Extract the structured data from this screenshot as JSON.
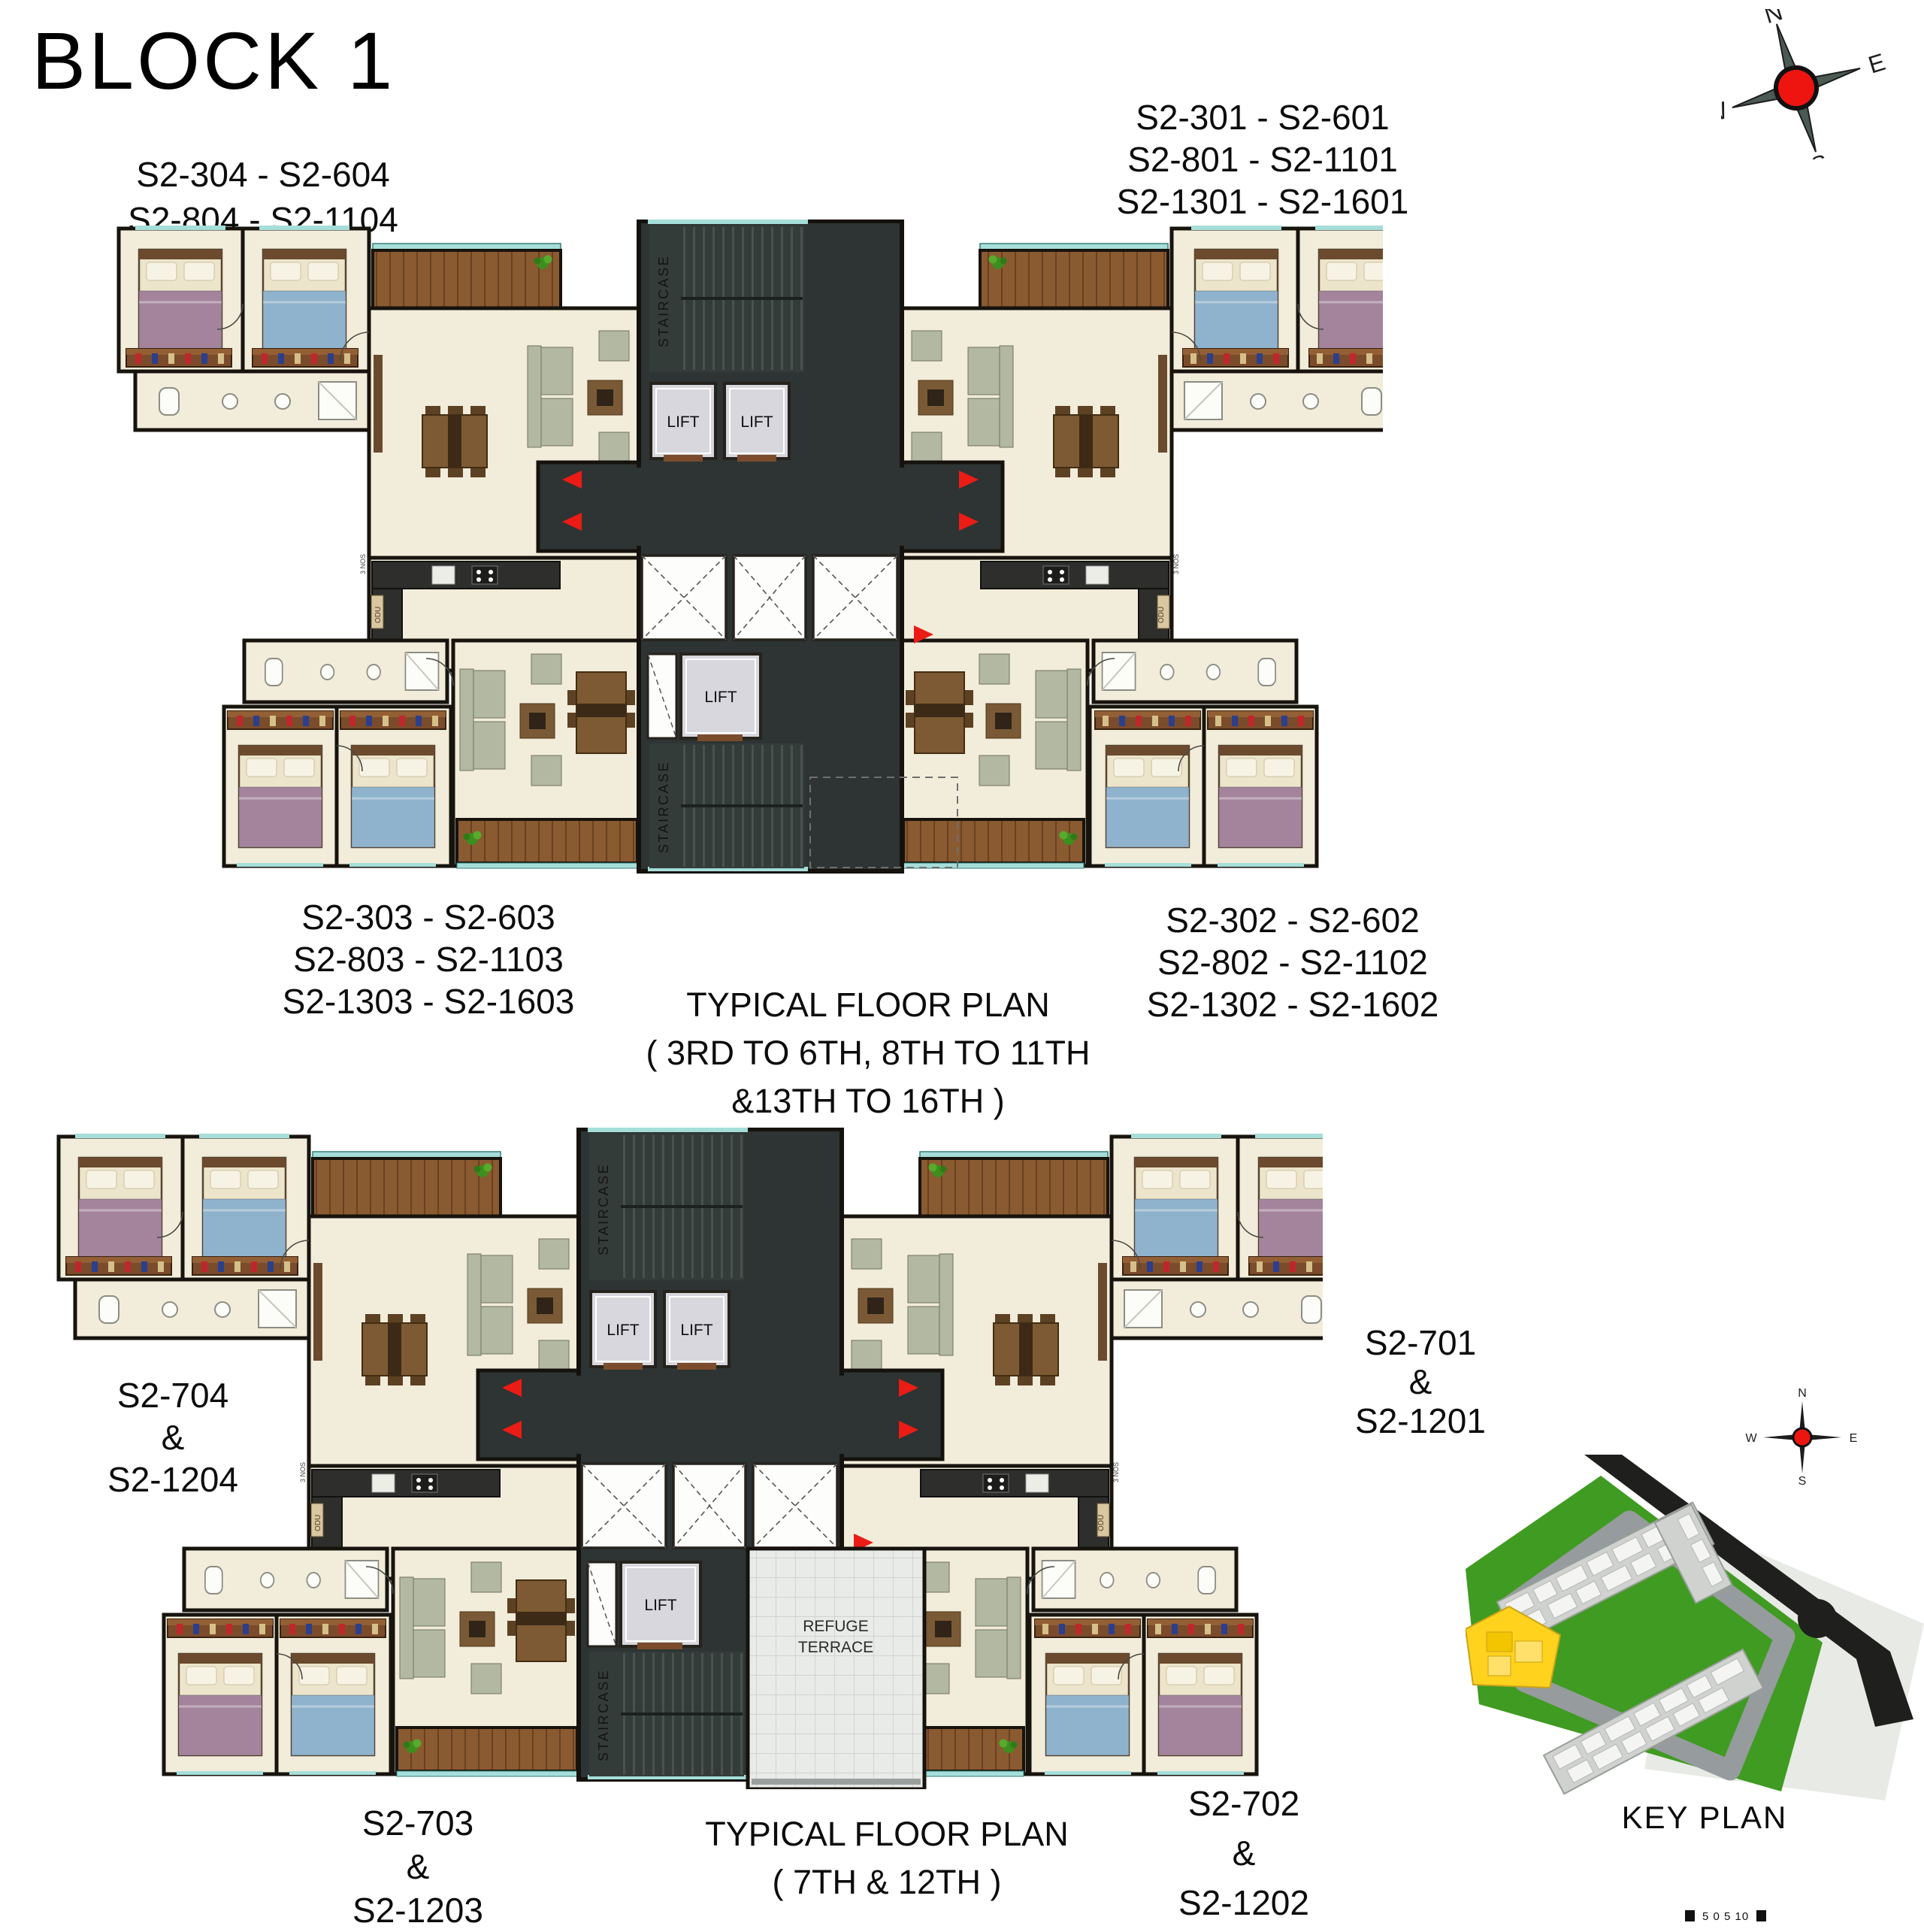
{
  "title": "BLOCK 1",
  "compass": {
    "n": "N",
    "e": "E",
    "s": "S",
    "w": "W"
  },
  "plan1": {
    "caption_line1": "TYPICAL FLOOR  PLAN",
    "caption_line2": "( 3RD TO 6TH, 8TH TO 11TH &13TH TO 16TH )",
    "unit_labels": {
      "top_left": [
        "S2-304 - S2-604",
        "S2-804 - S2-1104",
        "S2-1304 - S2-1604"
      ],
      "top_right": [
        "S2-301 - S2-601",
        "S2-801 - S2-1101",
        "S2-1301 - S2-1601"
      ],
      "bottom_left": [
        "S2-303 - S2-603",
        "S2-803 - S2-1103",
        "S2-1303 - S2-1603"
      ],
      "bottom_right": [
        "S2-302 - S2-602",
        "S2-802 - S2-1102",
        "S2-1302 - S2-1602"
      ]
    }
  },
  "plan2": {
    "caption_line1": "TYPICAL  FLOOR  PLAN",
    "caption_line2": "( 7TH & 12TH )",
    "unit_labels": {
      "left": [
        "S2-704",
        "&",
        "S2-1204"
      ],
      "right": [
        "S2-701",
        "&",
        "S2-1201"
      ],
      "bottom_left": [
        "S2-703",
        "&",
        "S2-1203"
      ],
      "bottom_right": [
        "S2-702",
        "&",
        "S2-1202"
      ]
    }
  },
  "plan_text": {
    "lift": "LIFT",
    "staircase": "STAIRCASE",
    "odu": "ODU",
    "nos": "3 NOS",
    "refuge_line1": "REFUGE",
    "refuge_line2": "TERRACE"
  },
  "key_plan": {
    "label": "KEY PLAN"
  },
  "scale_bar": {
    "ticks": "5  0  5  10"
  },
  "colors": {
    "wall": "#17130d",
    "floor_cream": "#f2ecda",
    "core_dark": "#2d3433",
    "wood_deck": "#8a5a31",
    "teal_edge": "#a6ded9",
    "lift_gray": "#d8d7dd",
    "bed_blue": "#8fb3cc",
    "bed_mauve": "#a3849c",
    "sofa_sage": "#b2b8a1",
    "arrow_red": "#ea1c15",
    "keyplan_green": "#3f9b21",
    "keyplan_yellow": "#ffd21d",
    "compass_red": "#ee1511"
  }
}
